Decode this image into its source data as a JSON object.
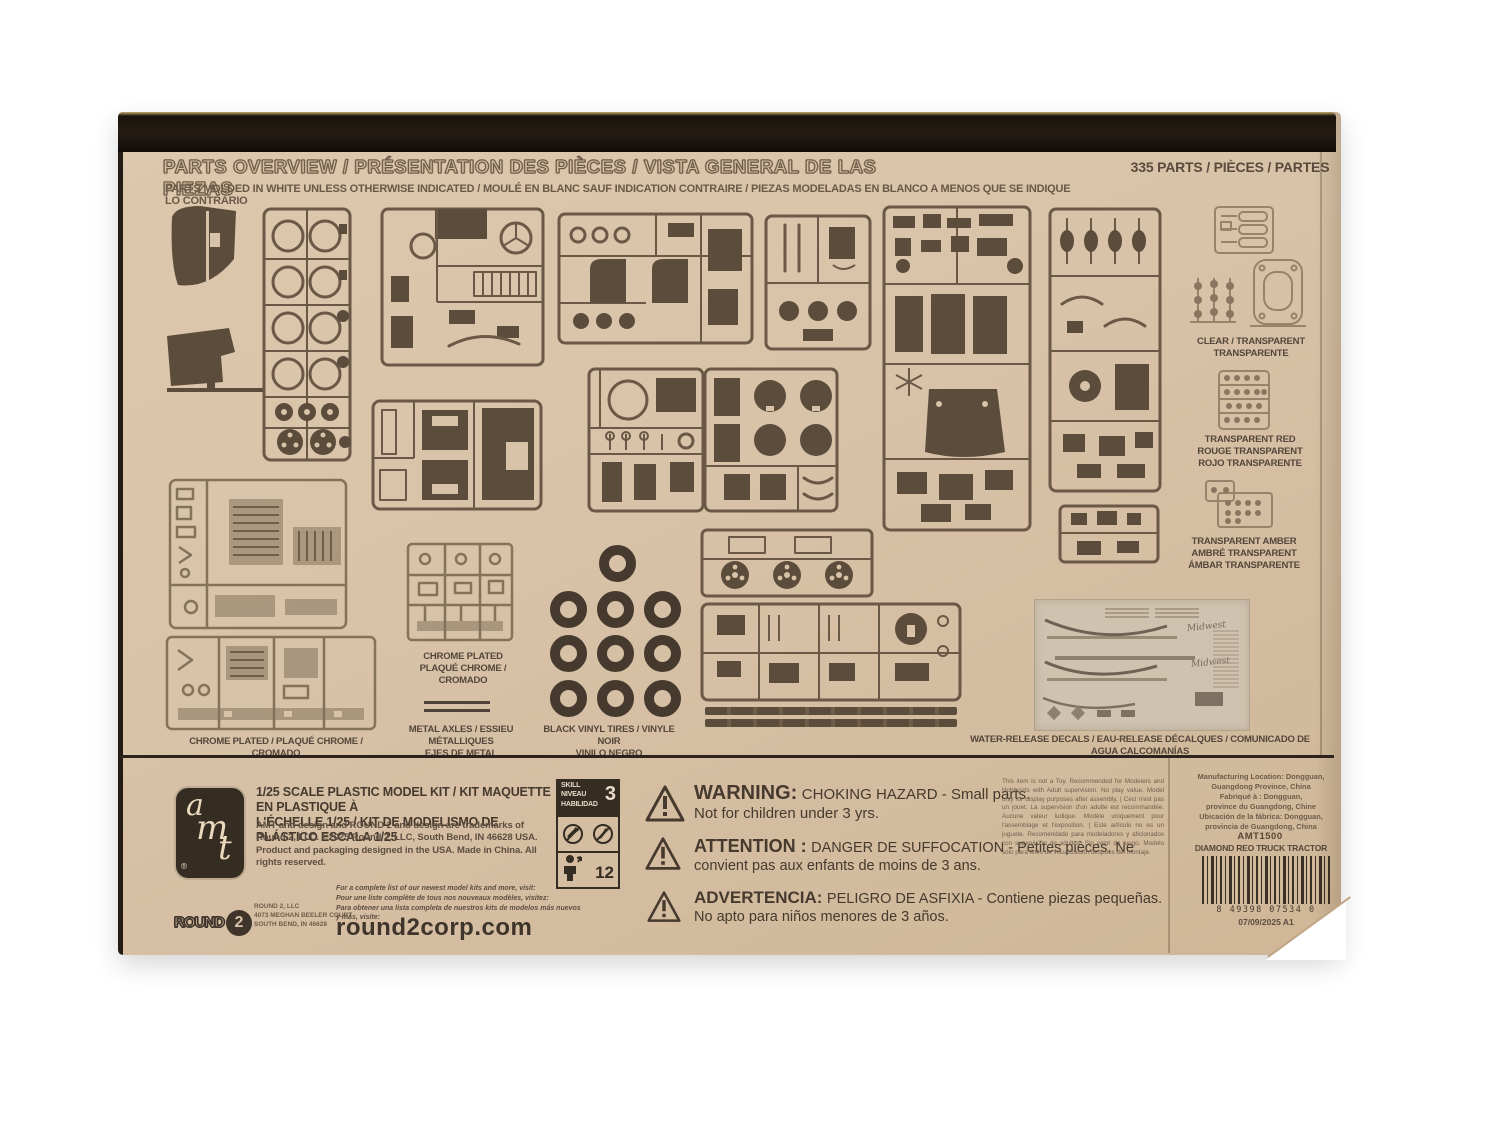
{
  "colors": {
    "kraft": "#d8c2a8",
    "print_dark": "#463a2e",
    "print_mid": "#6b5846",
    "print_light": "#97836b",
    "box_edge": "#17110c",
    "decal_bg": "#cfc2ae"
  },
  "header": {
    "title": "PARTS OVERVIEW / PRÉSENTATION DES PIÈCES / VISTA GENERAL DE LAS PIEZAS",
    "subtitle": "PARTS MOLDED IN WHITE UNLESS OTHERWISE INDICATED  / MOULÉ EN BLANC SAUF INDICATION CONTRAIRE / PIEZAS MODELADAS EN BLANCO A MENOS QUE SE INDIQUE LO CONTRARIO"
  },
  "parts_count": "335 PARTS / PIÈCES / PARTES",
  "side_labels": {
    "clear": "CLEAR / TRANSPARENT\nTRANSPARENTE",
    "red": "TRANSPARENT RED\nROUGE TRANSPARENT\nROJO TRANSPARENTE",
    "amber": "TRANSPARENT AMBER\nAMBRÉ TRANSPARENT\nÁMBAR TRANSPARENTE"
  },
  "bottom_labels": {
    "chrome_left": "CHROME PLATED / PLAQUÉ CHROME / CROMADO",
    "chrome_center": "CHROME PLATED\nPLAQUÉ CHROME / CROMADO",
    "metal_axles": "METAL AXLES / ESSIEU MÉTALLIQUES\nEJES DE METAL",
    "tires": "BLACK VINYL TIRES / VINYLE NOIR\nVINILO NEGRO",
    "decals": "WATER-RELEASE DECALS / EAU-RELEASE DÉCALQUES / COMUNICADO DE AGUA CALCOMANÍAS"
  },
  "decal_sheet": {
    "brand": "Midwest"
  },
  "footer": {
    "amt_letters": {
      "a": "a",
      "m": "m",
      "t": "t",
      "reg": "®"
    },
    "scale_title": "1/25 SCALE PLASTIC MODEL KIT / KIT MAQUETTE EN PLASTIQUE À\nL'ÉCHELLE 1/25 / KIT DE MODELISMO DE PLÁSTICO ESCALA 1/25",
    "trademark": "AMT and design and ROUND 2 and design are trademarks of Round 2, LLC. ©2025 Round 2, LLC, South Bend, IN 46628 USA.  Product and packaging designed in the USA. Made in China. All rights reserved.",
    "skill": {
      "w1": "SKILL",
      "w2": "NIVEAU",
      "w3": "HABILIDAD",
      "level": "3",
      "age": "12"
    },
    "warning_en": {
      "heading": "WARNING:",
      "line1": "CHOKING HAZARD - Small parts.",
      "line2": "Not for children under 3 yrs."
    },
    "warning_fr": {
      "heading": "ATTENTION :",
      "line1": "DANGER DE SUFFOCATION - Petites pièces. Ne",
      "line2": "convient pas aux enfants de moins de 3 ans."
    },
    "warning_es": {
      "heading": "ADVERTENCIA:",
      "line1": "PELIGRO DE ASFIXIA - Contiene piezas pequeñas.",
      "line2": "No apto para niños menores de 3 años."
    },
    "notice": "This item is not a Toy. Recommended for Modelers and Hobbyists with Adult supervision. No play value. Model only for display purposes after assembly. | Ceci n'est pas un jouet. La supervision d'un adulte est recommandée. Aucune valeur ludique. Modèle uniquement pour l'assemblage et l'exposition. | Este artículo no es un juguete. Recomendado para modeladores y aficionados con supervisión de adultos. Sin valor de juego. Modelo sólo para fines de visualización después del montaje.",
    "manufacturing": "Manufacturing Location: Dongguan,\nGuangdong Province, China\nFabriqué à : Dongguan,\nprovince du Guangdong, Chine\nUbicación de la fábrica: Dongguan,\nprovincia de Guangdong, China",
    "sku": "AMT1500",
    "product_name": "DIAMOND REO TRUCK TRACTOR",
    "barcode_digits": "8 49398 07534 0",
    "date_code": "07/09/2025 A1",
    "round2_logo": {
      "word": "ROUND",
      "num": "2"
    },
    "round2_address": "ROUND 2, LLC\n4073 MEGHAN BEELER COURT\nSOUTH BEND, IN 46628",
    "visit": "For a complete list of our newest model kits and more, visit:\nPour une liste complète de tous nos nouveaux modèles, visitez:\nPara obtener una lista completa de nuestros kits de modelos más nuevos y más, visite:",
    "website": "round2corp.com"
  }
}
